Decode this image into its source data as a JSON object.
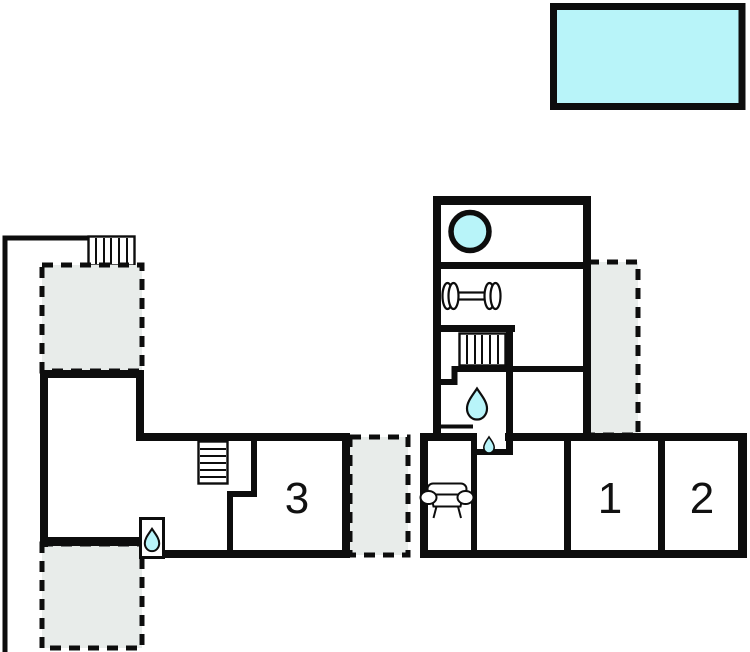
{
  "colors": {
    "wall": "#0d0d0d",
    "water": "#b8f4f9",
    "terrace": "#e8ecea",
    "background": "#ffffff"
  },
  "rooms": [
    {
      "name": "room-3",
      "label": "3"
    },
    {
      "name": "room-1",
      "label": "1"
    },
    {
      "name": "room-2",
      "label": "2"
    }
  ],
  "icons": [
    "swimming-pool",
    "hot-tub",
    "dumbbell",
    "staircase",
    "shower-drop",
    "sofa",
    "terrace-dashed-area",
    "property-boundary-line"
  ]
}
